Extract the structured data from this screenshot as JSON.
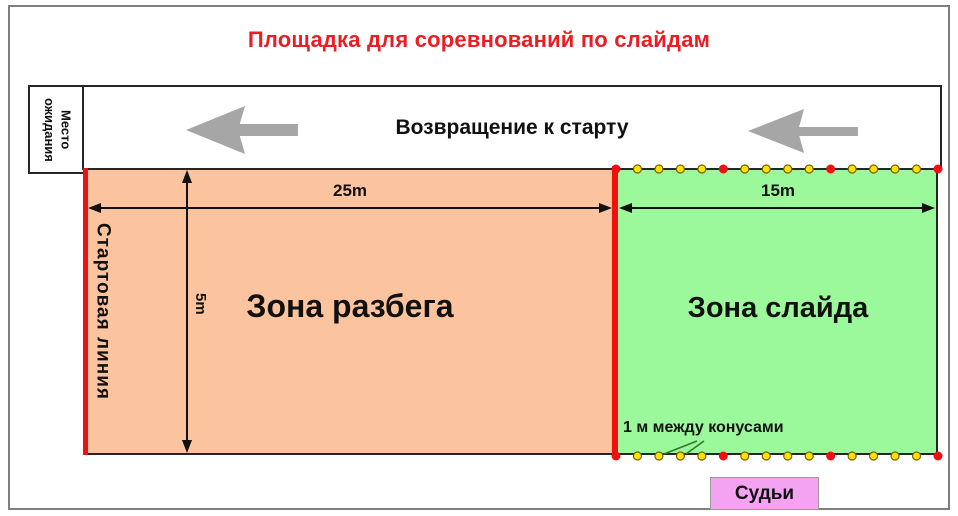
{
  "title": "Площадка для соревнований по слайдам",
  "title_color": "#EC1C24",
  "waiting_box": {
    "label": "Место ожидания",
    "lines": [
      "Место",
      "ожидания"
    ]
  },
  "return_lane": {
    "label": "Возвращение к старту",
    "arrow_direction": "left",
    "arrow_color": "#A6A6A6"
  },
  "zones": {
    "runup": {
      "label": "Зона разбега",
      "width_label": "25m",
      "height_label": "5m",
      "fill": "#FCC49E"
    },
    "slide": {
      "label": "Зона слайда",
      "width_label": "15m",
      "fill": "#9BF89B"
    }
  },
  "start_line": {
    "label": "Стартовая линия",
    "color": "#EE1111"
  },
  "cones": {
    "note": "1 м между конусами",
    "rows": 2,
    "per_row": 16,
    "red_indices": [
      0,
      5,
      10,
      15
    ],
    "yellow_color": "#FFE300",
    "yellow_ring_color": "#7a6000",
    "red_color": "#EE1111"
  },
  "judges": {
    "label": "Судьи",
    "fill": "#F4A3F2"
  }
}
